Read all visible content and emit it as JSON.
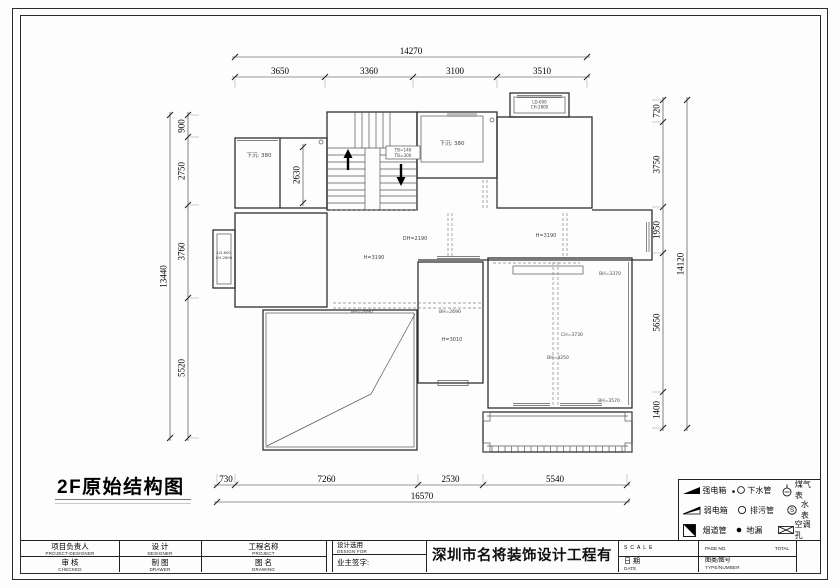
{
  "sheet": {
    "title": "2F原始结构图"
  },
  "dims": {
    "top_total": "14270",
    "top_segments": [
      "3650",
      "3360",
      "3100",
      "3510"
    ],
    "bottom_segments": [
      "730",
      "7260",
      "2530",
      "5540"
    ],
    "bottom_total": "16570",
    "left_segments": [
      "900",
      "2750",
      "3760",
      "5520"
    ],
    "left_total": "13440",
    "right_segments": [
      "720",
      "3750",
      "1950",
      "5650",
      "1400"
    ],
    "right_total": "14120",
    "interior_2630": "2630"
  },
  "labels": {
    "sunken_left": "下沉: 380",
    "sunken_mid": "下沉: 380",
    "stair_tb1": "TB=140",
    "stair_tb2": "TB=300",
    "bay_top_l1": "LD-600",
    "bay_top_l2": "CH-2800",
    "bay_left_l1": "LD-600",
    "bay_left_l2": "CH-2600",
    "hall_dh": "DH=2190",
    "hall_h": "H=3190",
    "living_h": "H=3190",
    "beam_left": "BH=2690",
    "beam_mid": "BH=2690",
    "mid_h": "H=3010",
    "right_bh_top": "BH=3370",
    "right_ch": "CH=3730",
    "right_bh_mid": "BH=4250",
    "right_bh_bottom": "BH=3570"
  },
  "legend": {
    "rows": [
      {
        "a": "强电箱",
        "b": "下水管",
        "c": "煤气表"
      },
      {
        "a": "弱电箱",
        "b": "排污管",
        "c": "水表"
      },
      {
        "a": "烟道管",
        "b": "地漏",
        "c": "空调孔"
      }
    ]
  },
  "title_block": {
    "company": "深圳市名将装饰设计工程有限公司",
    "f1_cn": "项目负责人",
    "f1_en": "PROJECT-DESIGNER",
    "f2_cn": "设 计",
    "f2_en": "DESIGNER",
    "f3_cn": "工程名称",
    "f3_en": "PROJECT",
    "f4_cn": "审 核",
    "f4_en": "CHECKED",
    "f5_cn": "制 图",
    "f5_en": "DRAWER",
    "f6_cn": "图 名",
    "f6_en": "DRAWING",
    "design_for_cn": "设计选用",
    "design_for_en": "DESIGN FOR",
    "owner_sign": "业主签字:",
    "scale": "SCALE",
    "date_cn": "日 期",
    "date_en": "DATE",
    "page_no": "PAGE NO.",
    "total": "TOTAL",
    "type_cn": "图类/图号",
    "type_en": "TYPE/NUMBER"
  }
}
